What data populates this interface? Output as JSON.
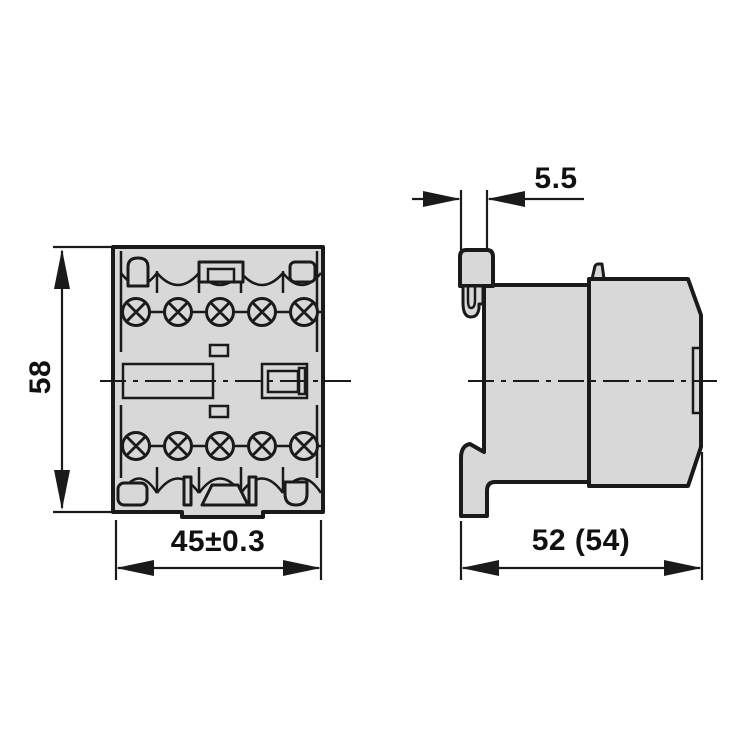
{
  "drawing": {
    "kind": "technical-dimension-drawing",
    "views": {
      "front": "front-view",
      "side": "side-view"
    },
    "dimensions": {
      "height": "58",
      "width": "45±0.3",
      "lug_width": "5.5",
      "depth": "52 (54)"
    },
    "colors": {
      "line": "#1a1a1a",
      "body_fill": "#d8d8d8",
      "background": "#ffffff"
    }
  }
}
